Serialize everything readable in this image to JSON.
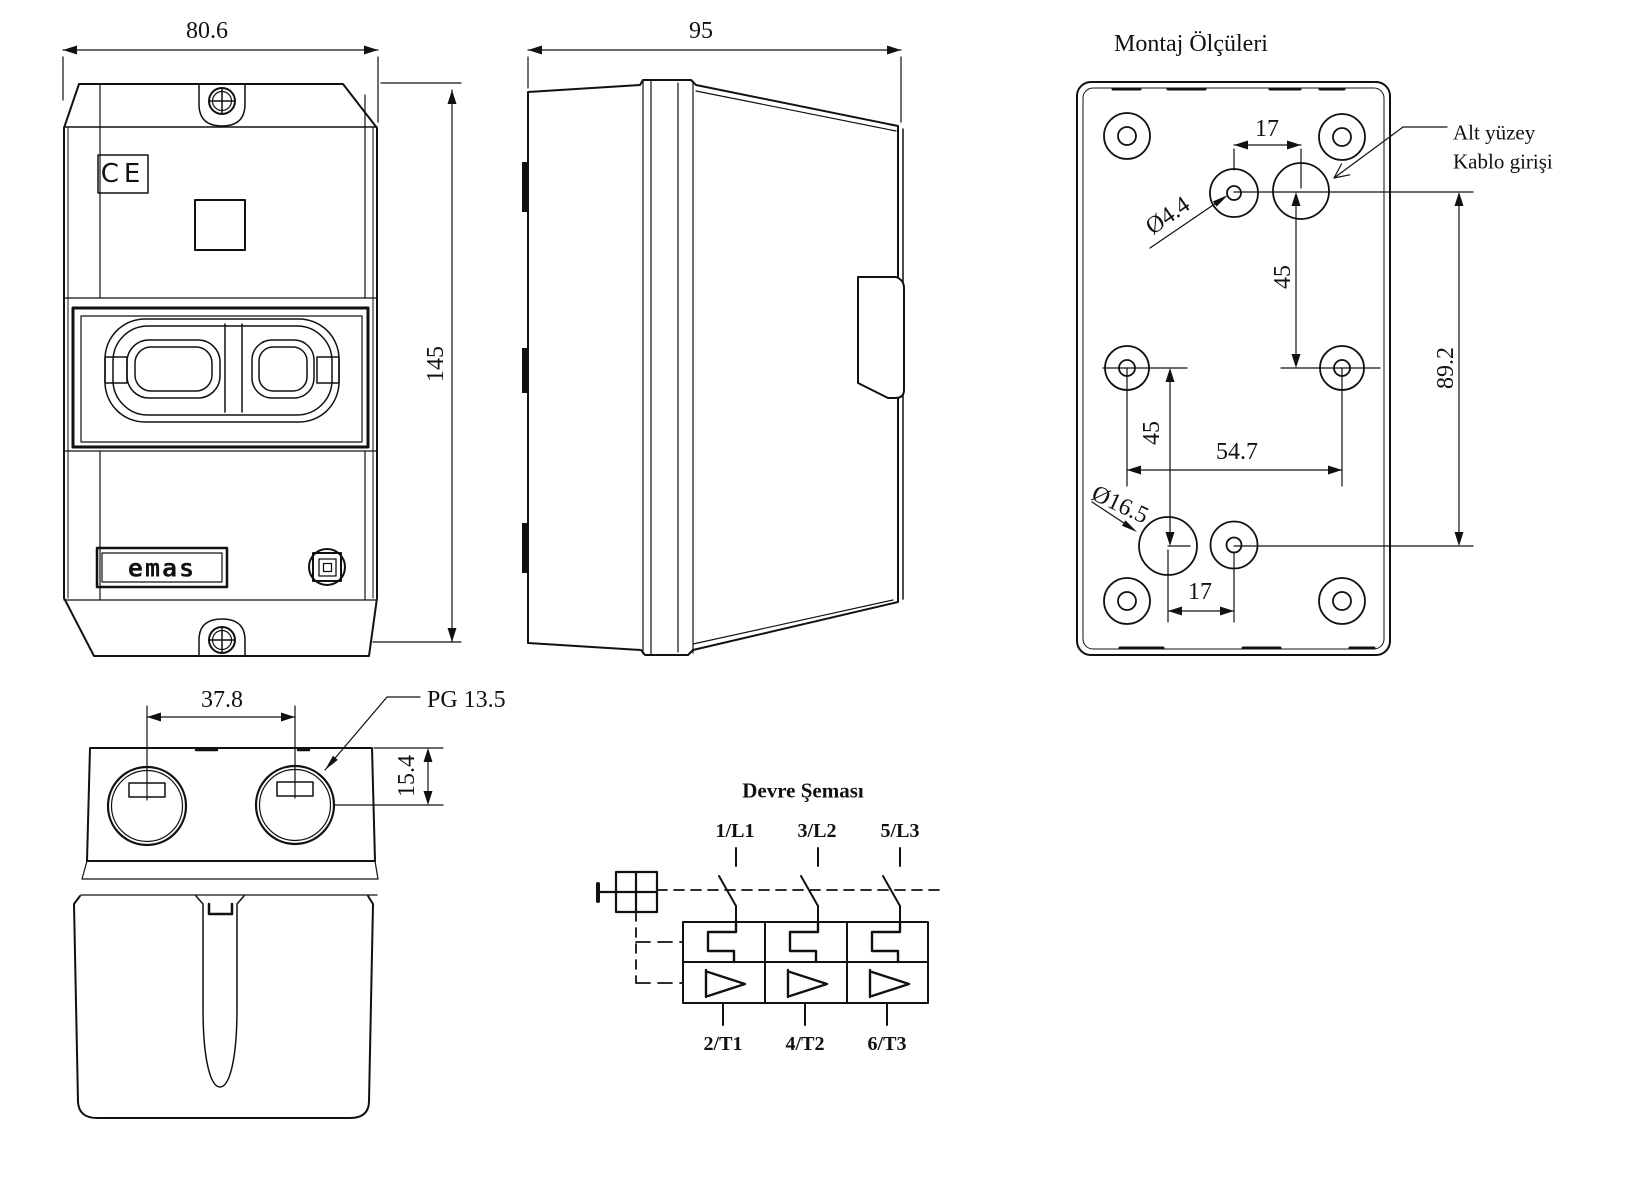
{
  "views": {
    "front": {
      "width_dim": "80.6",
      "height_dim": "145",
      "ce_mark": "CE",
      "brand": "emas"
    },
    "side": {
      "depth_dim": "95"
    },
    "mounting": {
      "title": "Montaj Ölçüleri",
      "top_spacing": "17",
      "small_hole_dia": "Ø4.4",
      "upper_vertical": "45",
      "cable_note_line1": "Alt yüzey",
      "cable_note_line2": "Kablo girişi",
      "overall_vertical": "89.2",
      "lower_vertical": "45",
      "horizontal_spacing": "54.7",
      "large_hole_dia": "Ø16.5",
      "bottom_spacing": "17"
    },
    "bottom": {
      "gland_spacing": "37.8",
      "gland_type": "PG 13.5",
      "edge_offset": "15.4"
    },
    "circuit": {
      "title": "Devre Şeması",
      "line_terminals": [
        "1/L1",
        "3/L2",
        "5/L3"
      ],
      "load_terminals": [
        "2/T1",
        "4/T2",
        "6/T3"
      ]
    }
  }
}
